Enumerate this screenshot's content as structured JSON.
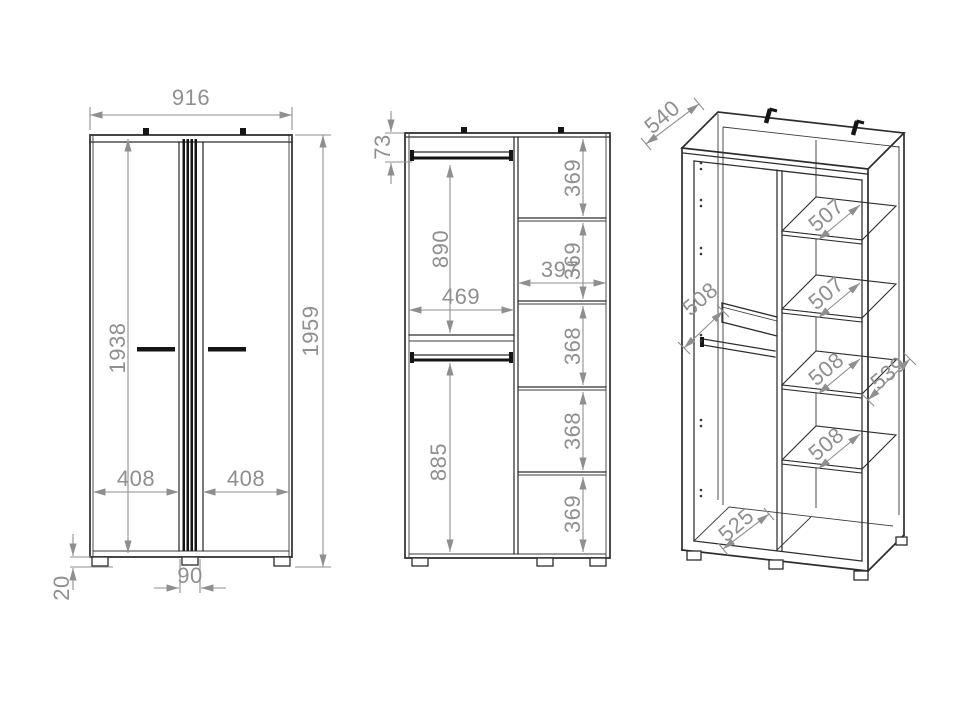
{
  "colors": {
    "background": "#ffffff",
    "outline": "#2d2d2d",
    "detail": "#151515",
    "dimension": "#8f8f8f"
  },
  "views": {
    "front": {
      "dims": {
        "overall_width": "916",
        "overall_height": "1959",
        "door_height": "1938",
        "left_door_width": "408",
        "right_door_width": "408",
        "bottom_gap": "90",
        "foot_height": "20"
      }
    },
    "internal": {
      "dims": {
        "rail_top_offset": "73",
        "upper_section_height": "890",
        "left_section_width": "469",
        "right_section_width": "397",
        "lower_section_height": "885",
        "compartment_1": "369",
        "compartment_2": "369",
        "compartment_3": "368",
        "compartment_4": "368",
        "compartment_5": "369"
      }
    },
    "perspective": {
      "dims": {
        "top_depth": "540",
        "hanging_depth": "508",
        "shelf_1_depth": "507",
        "shelf_2_depth": "507",
        "shelf_3_depth": "508",
        "shelf_4_depth": "508",
        "side_depth": "539",
        "floor_depth": "525"
      }
    }
  }
}
